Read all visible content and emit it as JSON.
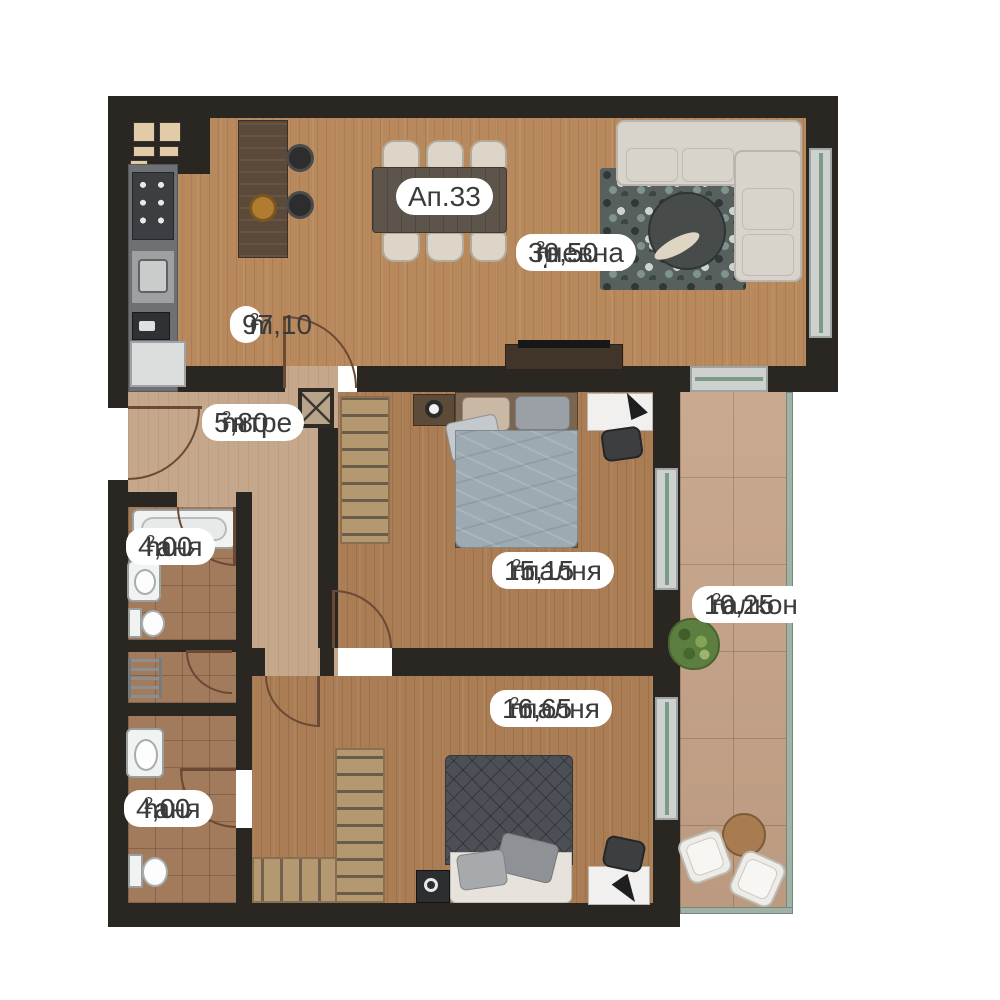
{
  "plan": {
    "apartment_label": "Ап.33",
    "unit": {
      "base": "m",
      "sup": "2"
    },
    "labels": {
      "total": {
        "area": "97,10"
      },
      "dnevna": {
        "room": "Дневна",
        "area": "30,50"
      },
      "antre": {
        "room": "Антре",
        "area": "5,80"
      },
      "banya1": {
        "room": "Баня",
        "area": "4,00"
      },
      "spalnya1": {
        "room": "Спалня",
        "area": "15,15"
      },
      "balkon": {
        "room": "Балкон",
        "area": "10,25"
      },
      "spalnya2": {
        "room": "Спалня",
        "area": "16,65"
      },
      "banya2": {
        "room": "Баня",
        "area": "4,00"
      }
    }
  },
  "colors": {
    "wall": "#2a2723",
    "wood": "#b8895c",
    "wood2": "#aa7d55",
    "antrefloor": "#c5a78b",
    "bathfloor": "#a27a5c",
    "balconyfloor": "#c5a287",
    "glass": "#7e9b85",
    "railc": "#9fb2a6",
    "doorline": "#6b4a35",
    "labeltext": "#3b3b3b",
    "sofac": "#d8d4cc",
    "bed1c": "#9daab1",
    "bed2c": "#4c5056",
    "closetc": "#b4986f",
    "plantc": "#5c7f41"
  }
}
